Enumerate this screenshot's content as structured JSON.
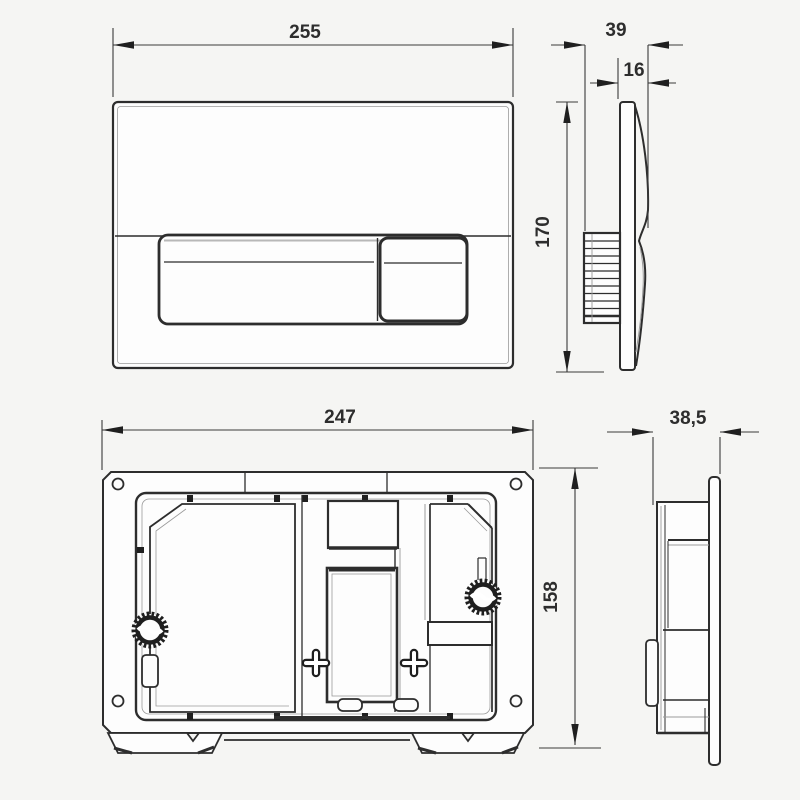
{
  "drawing": {
    "type": "technical-drawing",
    "subject": "dual-flush actuator plate and concealed cistern mounting frame, four orthographic views",
    "colors": {
      "line": "#2d2d2d",
      "background": "#f5f5f3",
      "surface": "#fdfdfd",
      "shadow": "#9a9a9a"
    }
  },
  "dimensions": {
    "front_width": "255",
    "front_height": "170",
    "side_total_depth": "39",
    "side_plate_depth": "16",
    "frame_width": "247",
    "frame_height": "158",
    "frame_depth": "38,5"
  }
}
